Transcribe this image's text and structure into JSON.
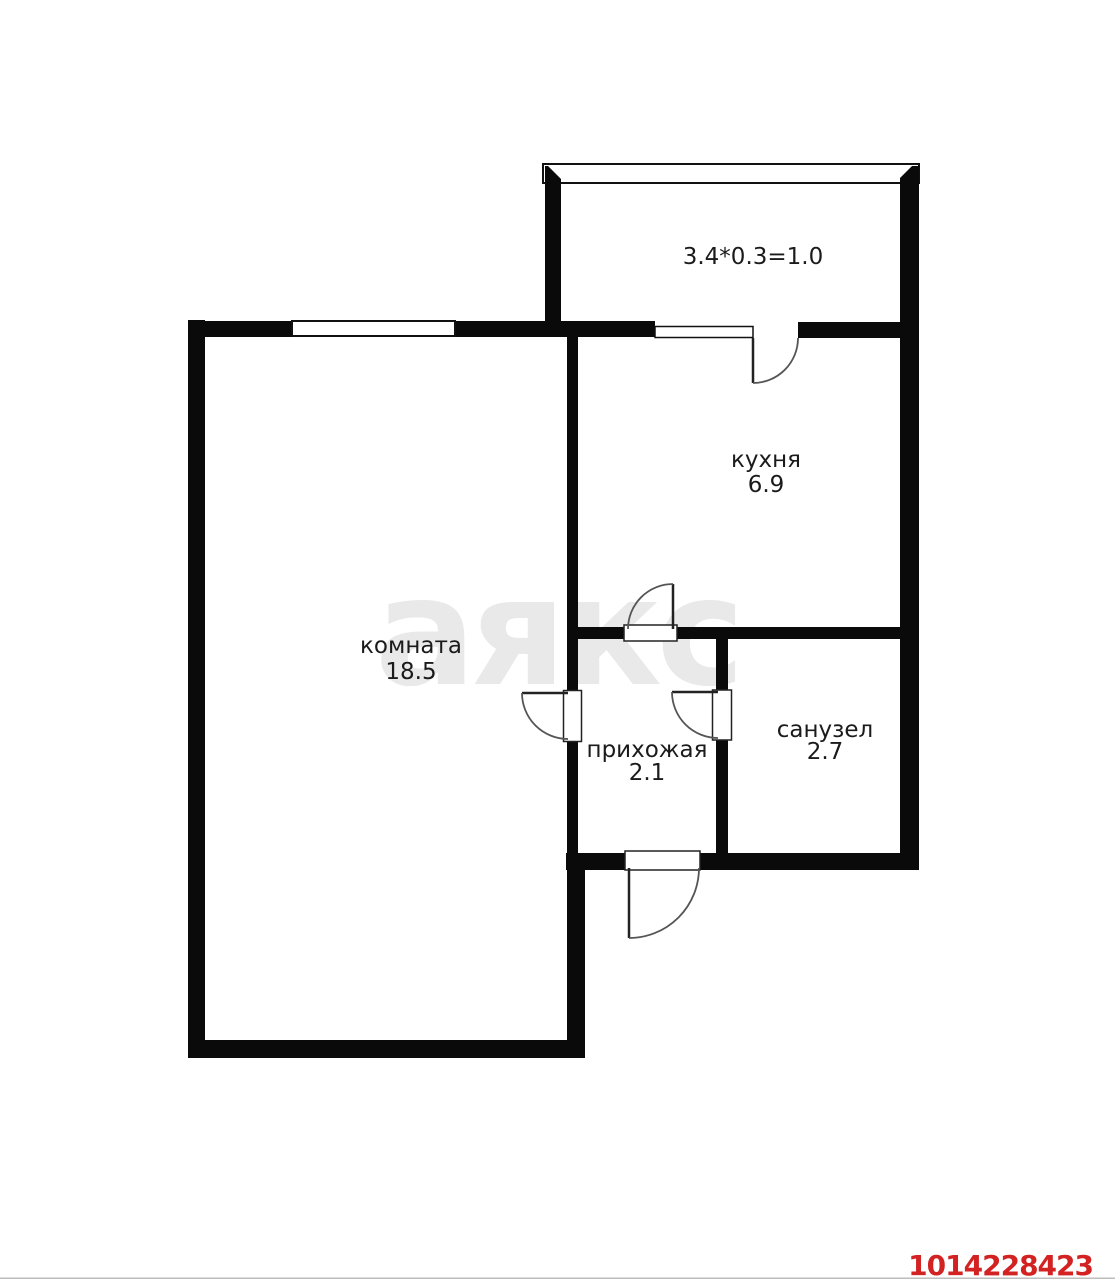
{
  "plan": {
    "watermark": "аякс",
    "listing_id": "1014228423",
    "balcony": {
      "formula": "3.4*0.3=1.0"
    },
    "rooms": [
      {
        "key": "room",
        "label": "комната",
        "area": "18.5"
      },
      {
        "key": "kitchen",
        "label": "кухня",
        "area": "6.9"
      },
      {
        "key": "hallway",
        "label": "прихожая",
        "area": "2.1"
      },
      {
        "key": "bathroom",
        "label": "санузел",
        "area": "2.7"
      }
    ],
    "colors": {
      "background": "#ffffff",
      "wall": "#0a0a0a",
      "label": "#1b1b1b",
      "watermark": "#e9e9e9",
      "listing_id": "#d32222"
    }
  }
}
